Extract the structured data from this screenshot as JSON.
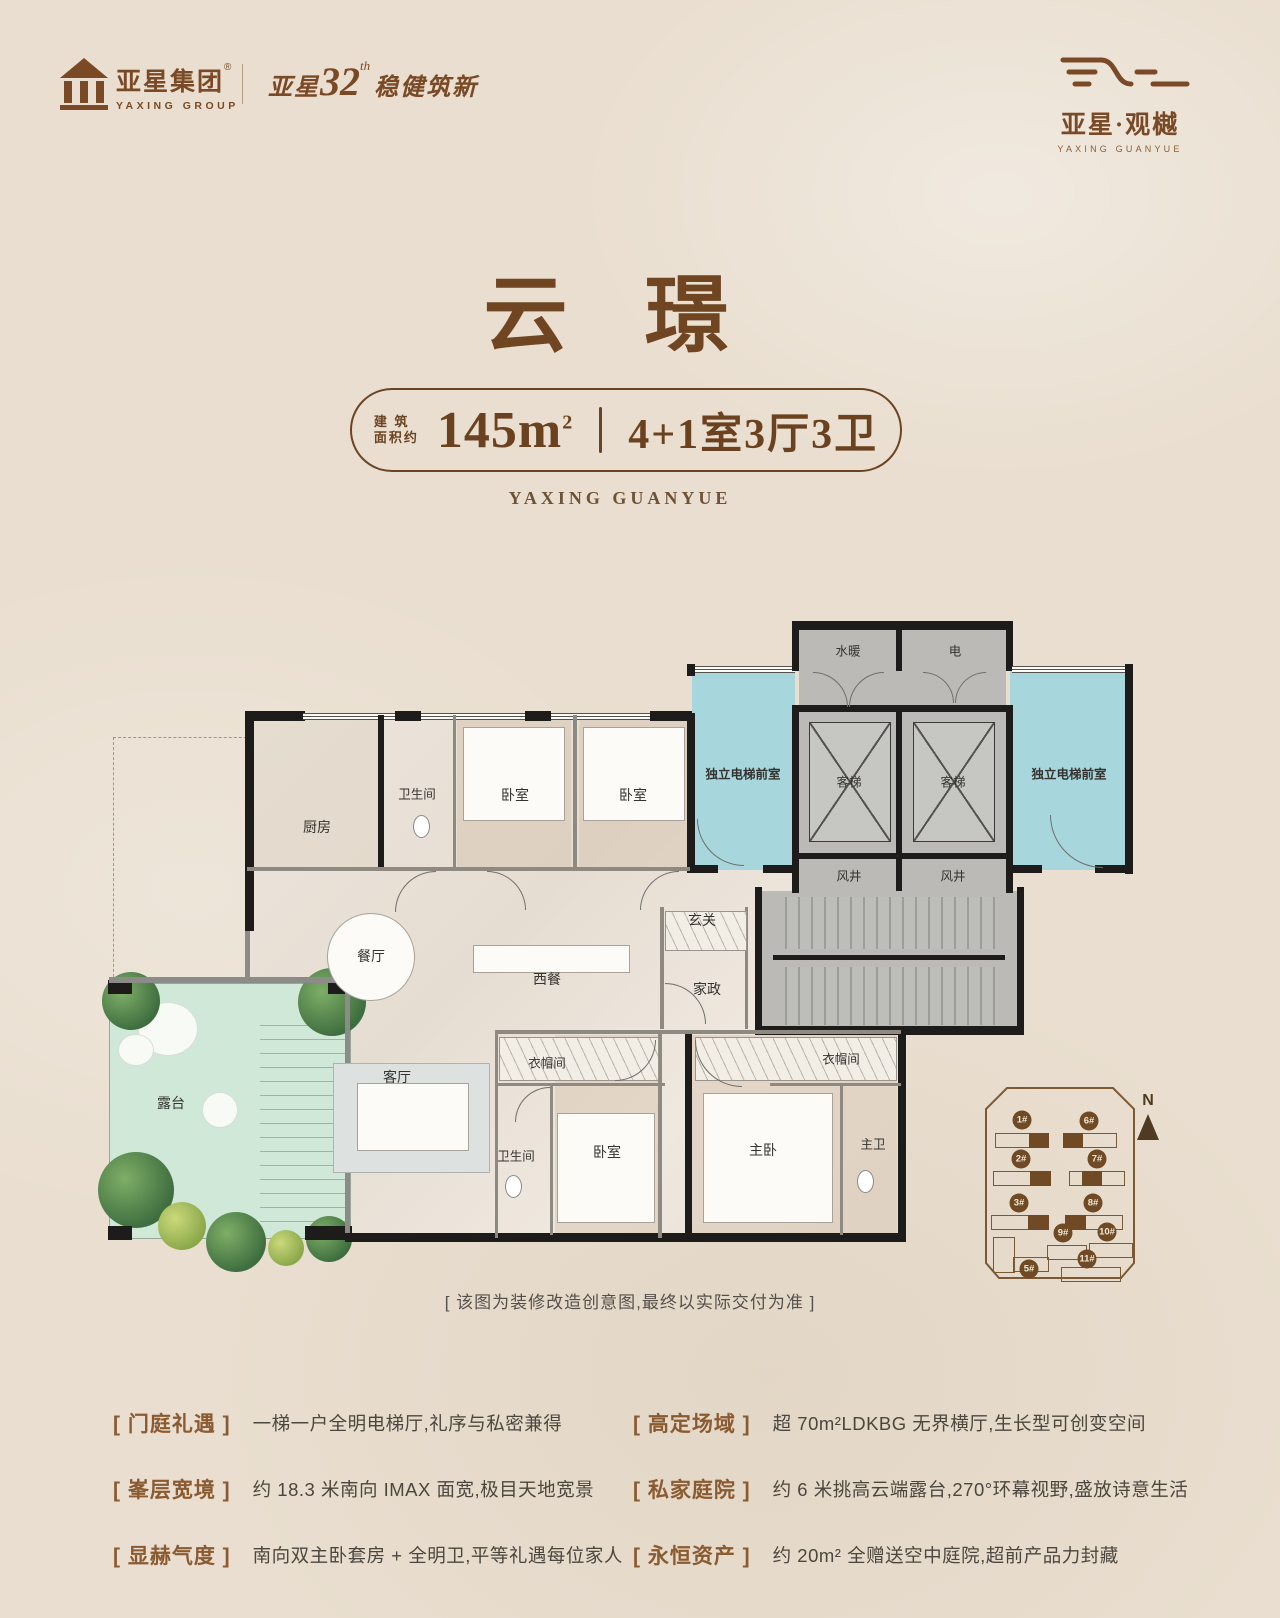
{
  "header": {
    "group_logo_cn": "亚星集团",
    "group_logo_reg": "®",
    "group_logo_en": "YAXING GROUP",
    "anniversary_pre": "亚星",
    "anniversary_num": "32",
    "anniversary_sup": "th",
    "anniversary_post": "稳健筑新",
    "brand_cn": "亚星·观樾",
    "brand_en": "YAXING GUANYUE"
  },
  "hero": {
    "title": "云 璟",
    "area_label_top": "建 筑",
    "area_label_bottom": "面积约",
    "area_value": "145m",
    "area_sup": "2",
    "layout_text": "4+1室3厅3卫",
    "subtitle": "YAXING GUANYUE"
  },
  "floorplan": {
    "rooms": [
      {
        "id": "kitchen",
        "label": "厨房"
      },
      {
        "id": "bath-top",
        "label": "卫生间"
      },
      {
        "id": "bedroom-1",
        "label": "卧室"
      },
      {
        "id": "bedroom-2",
        "label": "卧室"
      },
      {
        "id": "lobby-left",
        "label": "独立电梯前室"
      },
      {
        "id": "utility-water",
        "label": "水暖"
      },
      {
        "id": "utility-electric",
        "label": "电"
      },
      {
        "id": "elevator-1",
        "label": "客梯"
      },
      {
        "id": "elevator-2",
        "label": "客梯"
      },
      {
        "id": "shaft-1",
        "label": "风井"
      },
      {
        "id": "shaft-2",
        "label": "风井"
      },
      {
        "id": "lobby-right",
        "label": "独立电梯前室"
      },
      {
        "id": "foyer",
        "label": "玄关"
      },
      {
        "id": "dining",
        "label": "餐厅"
      },
      {
        "id": "western-dining",
        "label": "西餐"
      },
      {
        "id": "housekeeping",
        "label": "家政"
      },
      {
        "id": "terrace",
        "label": "露台"
      },
      {
        "id": "living",
        "label": "客厅"
      },
      {
        "id": "cloak-left",
        "label": "衣帽间"
      },
      {
        "id": "bath-bottom",
        "label": "卫生间"
      },
      {
        "id": "bedroom-3",
        "label": "卧室"
      },
      {
        "id": "master-bedroom",
        "label": "主卧"
      },
      {
        "id": "cloak-right",
        "label": "衣帽间"
      },
      {
        "id": "master-bath",
        "label": "主卫"
      }
    ],
    "disclaimer": "[ 该图为装修改造创意图,最终以实际交付为准 ]"
  },
  "sitemap": {
    "north": "N",
    "buildings": [
      "1#",
      "6#",
      "2#",
      "7#",
      "3#",
      "8#",
      "9#",
      "10#",
      "11#",
      "5#"
    ]
  },
  "features": {
    "left": [
      {
        "tag": "[ 门庭礼遇 ]",
        "desc": "一梯一户全明电梯厅,礼序与私密兼得"
      },
      {
        "tag": "[ 峯层宽境 ]",
        "desc": "约 18.3 米南向 IMAX 面宽,极目天地宽景"
      },
      {
        "tag": "[ 显赫气度 ]",
        "desc": "南向双主卧套房 + 全明卫,平等礼遇每位家人"
      }
    ],
    "right": [
      {
        "tag": "[ 高定场域 ]",
        "desc": "超 70m²LDKBG 无界横厅,生长型可创变空间"
      },
      {
        "tag": "[ 私家庭院 ]",
        "desc": "约 6 米挑高云端露台,270°环幕视野,盛放诗意生活"
      },
      {
        "tag": "[ 永恒资产 ]",
        "desc": "约 20m² 全赠送空中庭院,超前产品力封藏"
      }
    ]
  },
  "colors": {
    "accent_brown": "#6f4522",
    "lobby_blue": "#a7d7dd",
    "terrace_green": "#cfe8d7",
    "background": "#e9decf"
  }
}
